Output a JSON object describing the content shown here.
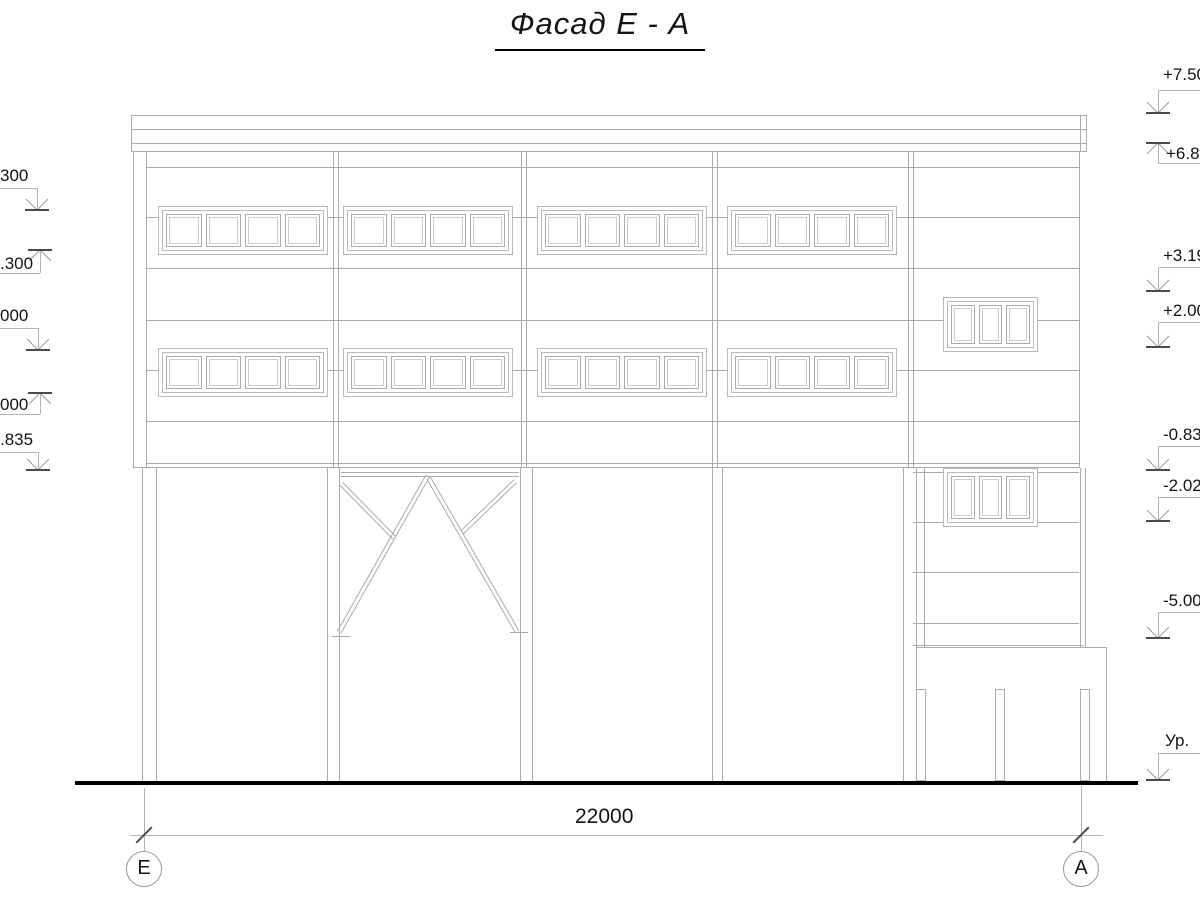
{
  "title": {
    "text": "Фасад Е - А"
  },
  "colors": {
    "line": "#ababab",
    "dark": "#4a4a4a",
    "text": "#141414",
    "ground": "#000000"
  },
  "dimension": {
    "value": "22000"
  },
  "axes": [
    {
      "label": "Е",
      "cx": 144,
      "cy": 869
    },
    {
      "label": "А",
      "cx": 1081,
      "cy": 869
    }
  ],
  "elevation_marks": [
    {
      "side": "left",
      "label": "300",
      "label_x": 0,
      "label_w": 28,
      "label_y": 166,
      "leader_y": 188,
      "riser_x": 37,
      "arrow_y": 210,
      "dir": "down"
    },
    {
      "side": "left",
      "label": ".300",
      "label_x": 0,
      "label_w": 33,
      "label_y": 254,
      "leader_y": 273,
      "riser_x": 40,
      "arrow_y": 250,
      "dir": "up"
    },
    {
      "side": "left",
      "label": "000",
      "label_x": 0,
      "label_w": 28,
      "label_y": 306,
      "leader_y": 328,
      "riser_x": 38,
      "arrow_y": 350,
      "dir": "down"
    },
    {
      "side": "left",
      "label": "000",
      "label_x": 0,
      "label_w": 28,
      "label_y": 395,
      "leader_y": 414,
      "riser_x": 40,
      "arrow_y": 393,
      "dir": "up"
    },
    {
      "side": "left",
      "label": ".835",
      "label_x": 0,
      "label_w": 33,
      "label_y": 430,
      "leader_y": 452,
      "riser_x": 38,
      "arrow_y": 470,
      "dir": "down"
    },
    {
      "side": "right",
      "label": "+7.50",
      "label_x": 1163,
      "label_w": 60,
      "label_y": 65,
      "leader_y": 90,
      "riser_x": 1158,
      "arrow_y": 113,
      "dir": "down"
    },
    {
      "side": "right",
      "label": "+6.8",
      "label_x": 1166,
      "label_w": 60,
      "label_y": 144,
      "leader_y": 163,
      "riser_x": 1158,
      "arrow_y": 143,
      "dir": "up"
    },
    {
      "side": "right",
      "label": "+3.19",
      "label_x": 1163,
      "label_w": 60,
      "label_y": 246,
      "leader_y": 267,
      "riser_x": 1158,
      "arrow_y": 291,
      "dir": "down"
    },
    {
      "side": "right",
      "label": "+2.00",
      "label_x": 1163,
      "label_w": 60,
      "label_y": 301,
      "leader_y": 322,
      "riser_x": 1158,
      "arrow_y": 347,
      "dir": "down"
    },
    {
      "side": "right",
      "label": "-0.83",
      "label_x": 1163,
      "label_w": 60,
      "label_y": 425,
      "leader_y": 446,
      "riser_x": 1158,
      "arrow_y": 470,
      "dir": "down"
    },
    {
      "side": "right",
      "label": "-2.02",
      "label_x": 1163,
      "label_w": 60,
      "label_y": 476,
      "leader_y": 497,
      "riser_x": 1158,
      "arrow_y": 521,
      "dir": "down"
    },
    {
      "side": "right",
      "label": "-5.00",
      "label_x": 1163,
      "label_w": 60,
      "label_y": 591,
      "leader_y": 612,
      "riser_x": 1158,
      "arrow_y": 638,
      "dir": "down"
    },
    {
      "side": "right",
      "label": "Ур.",
      "label_x": 1165,
      "label_w": 60,
      "label_y": 731,
      "leader_y": 753,
      "riser_x": 1158,
      "arrow_y": 780,
      "dir": "down"
    }
  ],
  "drawing": {
    "rects": [
      {
        "n": "roof-band",
        "x": 131,
        "y": 115,
        "w": 956,
        "h": 37
      },
      {
        "n": "facade-body",
        "x": 133,
        "y": 151,
        "w": 947,
        "h": 317
      },
      {
        "n": "porch-foundation",
        "x": 916,
        "y": 647,
        "w": 191,
        "h": 135
      },
      {
        "n": "porch-post",
        "x": 916,
        "y": 689,
        "w": 10,
        "h": 92
      },
      {
        "n": "porch-post",
        "x": 995,
        "y": 689,
        "w": 10,
        "h": 92
      },
      {
        "n": "porch-post",
        "x": 1080,
        "y": 689,
        "w": 10,
        "h": 92
      }
    ],
    "hlines": [
      {
        "n": "roof-band-line",
        "y": 129,
        "x1": 131,
        "x2": 1086
      },
      {
        "n": "roof-band-line",
        "y": 143,
        "x1": 131,
        "x2": 1086
      },
      {
        "n": "facade-joint",
        "y": 167,
        "x1": 146,
        "x2": 1079
      },
      {
        "n": "facade-joint",
        "y": 217,
        "x1": 146,
        "x2": 1079
      },
      {
        "n": "facade-joint",
        "y": 268,
        "x1": 146,
        "x2": 1079
      },
      {
        "n": "facade-joint",
        "y": 320,
        "x1": 146,
        "x2": 1079
      },
      {
        "n": "facade-joint",
        "y": 370,
        "x1": 146,
        "x2": 1079
      },
      {
        "n": "facade-joint",
        "y": 421,
        "x1": 146,
        "x2": 1079
      },
      {
        "n": "facade-joint",
        "y": 463,
        "x1": 146,
        "x2": 1079
      },
      {
        "n": "tower-joint",
        "y": 472,
        "x1": 913,
        "x2": 1079
      },
      {
        "n": "tower-joint",
        "y": 522,
        "x1": 913,
        "x2": 1079
      },
      {
        "n": "tower-joint",
        "y": 572,
        "x1": 913,
        "x2": 1079
      },
      {
        "n": "tower-joint",
        "y": 623,
        "x1": 913,
        "x2": 1079
      },
      {
        "n": "tower-joint",
        "y": 645,
        "x1": 913,
        "x2": 1084
      },
      {
        "n": "brace-foot-plate",
        "y": 636,
        "x1": 332,
        "x2": 350
      },
      {
        "n": "brace-foot-plate",
        "y": 632,
        "x1": 510,
        "x2": 528
      }
    ],
    "vlines": [
      {
        "n": "roof-band-edge",
        "x": 1080,
        "y1": 115,
        "y2": 151
      },
      {
        "n": "facade-edge",
        "x": 146,
        "y1": 151,
        "y2": 468
      },
      {
        "n": "facade-joint-v",
        "x": 333,
        "y1": 151,
        "y2": 468
      },
      {
        "n": "facade-joint-v",
        "x": 338,
        "y1": 151,
        "y2": 468
      },
      {
        "n": "facade-joint-v",
        "x": 521,
        "y1": 151,
        "y2": 468
      },
      {
        "n": "facade-joint-v",
        "x": 526,
        "y1": 151,
        "y2": 468
      },
      {
        "n": "facade-joint-v",
        "x": 712,
        "y1": 151,
        "y2": 468
      },
      {
        "n": "facade-joint-v",
        "x": 717,
        "y1": 151,
        "y2": 468
      },
      {
        "n": "facade-joint-v",
        "x": 908,
        "y1": 151,
        "y2": 468
      },
      {
        "n": "facade-joint-v",
        "x": 913,
        "y1": 151,
        "y2": 468
      },
      {
        "n": "tower-wall",
        "x": 924,
        "y1": 468,
        "y2": 647
      },
      {
        "n": "tower-wall",
        "x": 1080,
        "y1": 468,
        "y2": 647
      },
      {
        "n": "tower-wall",
        "x": 1085,
        "y1": 468,
        "y2": 647
      }
    ],
    "columns": [
      {
        "n": "column",
        "x": 142,
        "w": 15,
        "y1": 468,
        "y2": 782
      },
      {
        "n": "column",
        "x": 327,
        "w": 13,
        "y1": 468,
        "y2": 782
      },
      {
        "n": "column",
        "x": 520,
        "w": 13,
        "y1": 468,
        "y2": 782
      },
      {
        "n": "column",
        "x": 712,
        "w": 11,
        "y1": 468,
        "y2": 782
      },
      {
        "n": "column",
        "x": 903,
        "w": 14,
        "y1": 468,
        "y2": 782
      }
    ],
    "windows": [
      {
        "n": "ribbon-window",
        "x": 158,
        "y": 206,
        "w": 170,
        "h": 49,
        "panes": 4
      },
      {
        "n": "ribbon-window",
        "x": 343,
        "y": 206,
        "w": 170,
        "h": 49,
        "panes": 4
      },
      {
        "n": "ribbon-window",
        "x": 537,
        "y": 206,
        "w": 170,
        "h": 49,
        "panes": 4
      },
      {
        "n": "ribbon-window",
        "x": 727,
        "y": 206,
        "w": 170,
        "h": 49,
        "panes": 4
      },
      {
        "n": "ribbon-window",
        "x": 158,
        "y": 348,
        "w": 170,
        "h": 49,
        "panes": 4
      },
      {
        "n": "ribbon-window",
        "x": 343,
        "y": 348,
        "w": 170,
        "h": 49,
        "panes": 4
      },
      {
        "n": "ribbon-window",
        "x": 537,
        "y": 348,
        "w": 170,
        "h": 49,
        "panes": 4
      },
      {
        "n": "ribbon-window",
        "x": 727,
        "y": 348,
        "w": 170,
        "h": 49,
        "panes": 4
      },
      {
        "n": "stair-window",
        "x": 943,
        "y": 297,
        "w": 95,
        "h": 55,
        "panes": 3
      },
      {
        "n": "stair-window",
        "x": 943,
        "y": 468,
        "w": 95,
        "h": 59,
        "panes": 3
      }
    ],
    "braces": [
      {
        "n": "brace-top-chord",
        "x1": 341,
        "y1": 472,
        "x2": 519,
        "y2": 472
      },
      {
        "n": "brace-diagonal",
        "x1": 430,
        "y1": 477,
        "x2": 341,
        "y2": 634
      },
      {
        "n": "brace-diagonal",
        "x1": 431,
        "y1": 477,
        "x2": 519,
        "y2": 630
      },
      {
        "n": "brace-diagonal",
        "x1": 343,
        "y1": 482,
        "x2": 396,
        "y2": 536
      },
      {
        "n": "brace-diagonal",
        "x1": 517,
        "y1": 483,
        "x2": 464,
        "y2": 534
      }
    ],
    "ground": {
      "x1": 75,
      "x2": 1138,
      "y": 781,
      "h": 4
    },
    "dim": {
      "line_y": 835,
      "x1": 130,
      "x2": 1103,
      "ext": [
        {
          "x": 144,
          "y1": 788,
          "y2": 851
        },
        {
          "x": 1081,
          "y1": 786,
          "y2": 851
        }
      ],
      "ticks": [
        144,
        1081
      ],
      "label_x": 575,
      "label_y": 805
    }
  }
}
